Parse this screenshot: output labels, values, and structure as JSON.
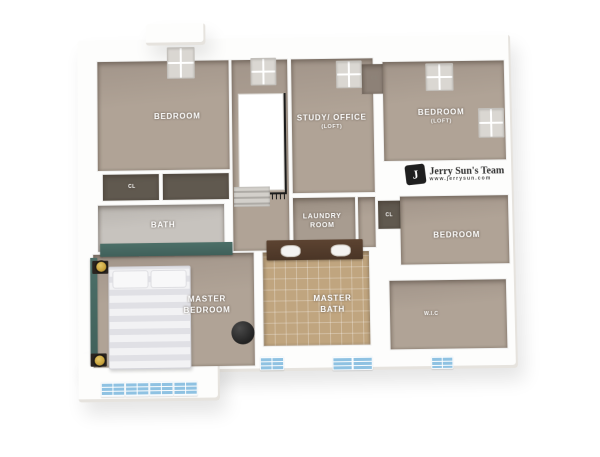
{
  "page": {
    "title": "Second floor 3D floor plan rendering"
  },
  "watermark": {
    "brand": "Jerry Sun's Team",
    "website": "www.jerrysun.com",
    "monogram": "J"
  },
  "rooms": {
    "bedroom_top_left": {
      "name": "BEDROOM"
    },
    "study_office": {
      "name": "STUDY/ OFFICE",
      "note": "(LOFT)"
    },
    "bedroom_loft": {
      "name": "BEDROOM",
      "note": "(LOFT)"
    },
    "bath": {
      "name": "BATH"
    },
    "laundry_room": {
      "name_line1": "LAUNDRY",
      "name_line2": "ROOM"
    },
    "bedroom_right": {
      "name": "BEDROOM"
    },
    "master_bedroom": {
      "name_line1": "MASTER",
      "name_line2": "BEDROOM"
    },
    "master_bath": {
      "name_line1": "MASTER",
      "name_line2": "BATH"
    },
    "walk_in_closet": {
      "name": "W.I.C"
    },
    "closet_hall": {
      "name": "CL"
    },
    "closet_study": {
      "name": "CL"
    },
    "closet_laundry": {
      "name": "CL"
    }
  },
  "colors": {
    "background": "#ffffff",
    "wall_white": "#fdfdfc",
    "wall_shadow": "#e6e3de",
    "floor_tan": "#b0a396",
    "floor_tan_dark": "#a2958a",
    "floor_gray": "#c7c3be",
    "floor_laundry": "#a89c90",
    "closet_dark": "#60594f",
    "closet_mid": "#8d8177",
    "tile_tan": "#c0a57f",
    "vanity_brown": "#4a3526",
    "window_blue": "#8fc2e2",
    "window_gray": "#dad7d2",
    "accent_teal": "#40605a",
    "railing_black": "#1b1b1b",
    "bed_white": "#ececef",
    "lamp_gold": "#c8a23c",
    "label_text": "#ffffff",
    "logo_text": "#2e2e2e"
  }
}
